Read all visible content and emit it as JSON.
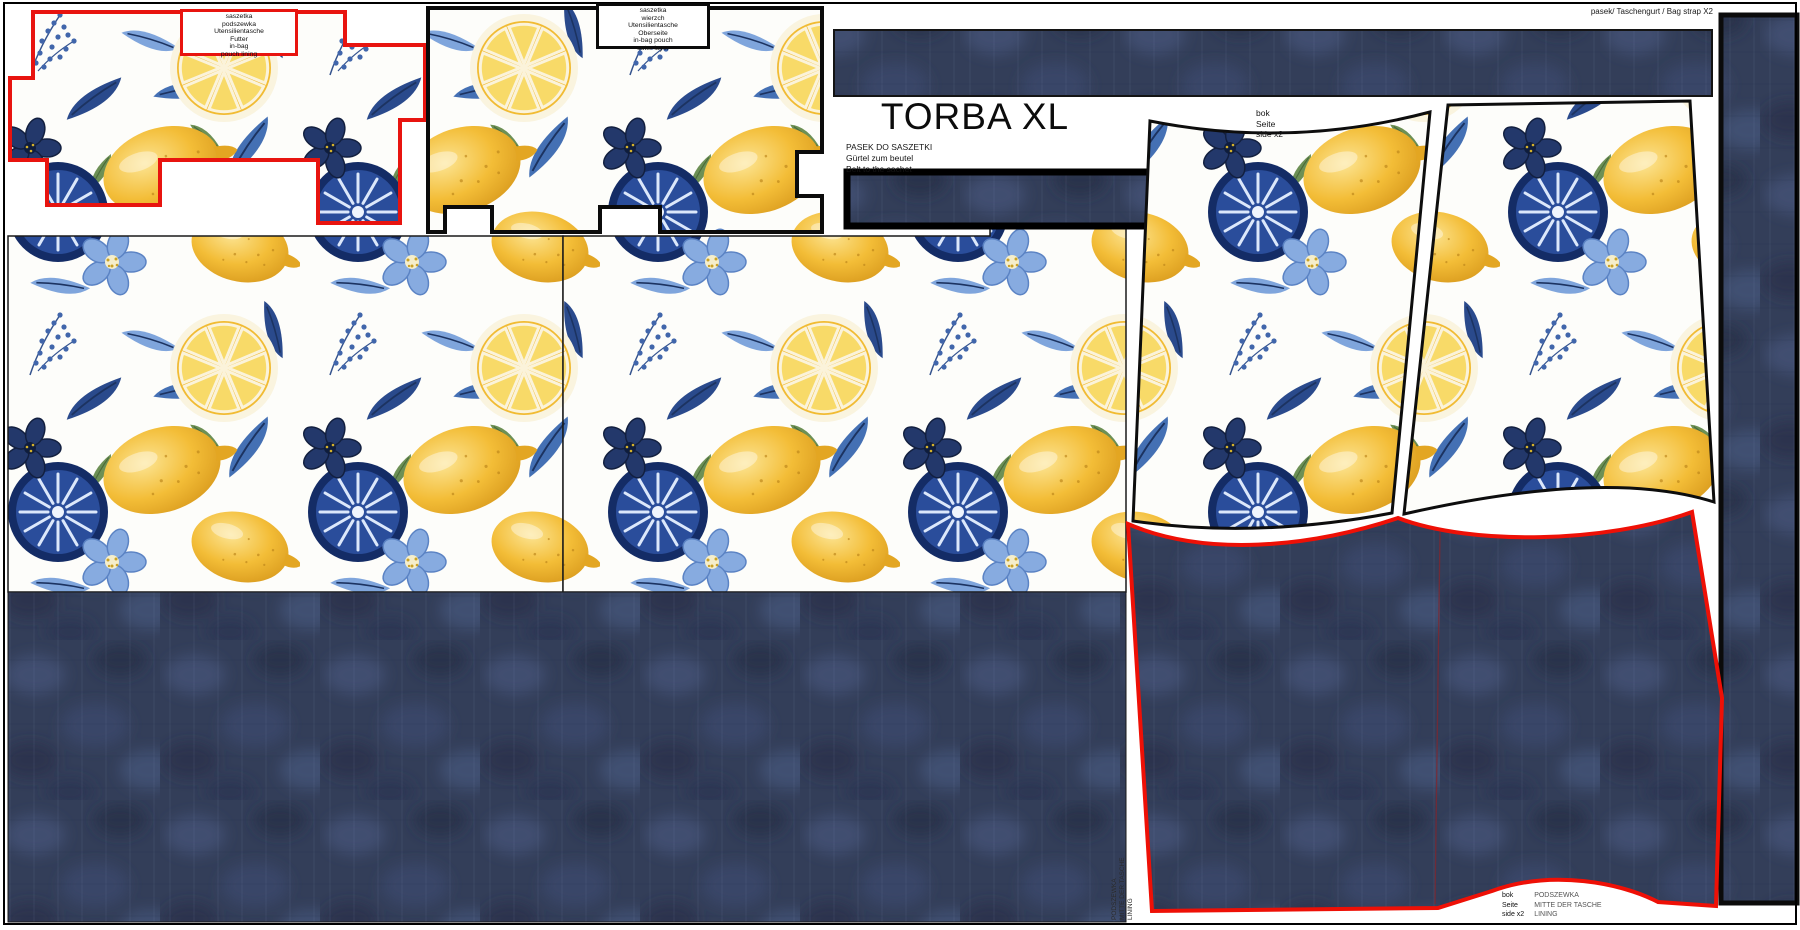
{
  "title": "TORBA XL",
  "labels": {
    "pouch_lining": {
      "lines": [
        "saszetka",
        "podszewka",
        "Utensilientasche",
        "Futter",
        "in-bag",
        "pouch lining"
      ]
    },
    "pouch_outer": {
      "lines": [
        "saszetka",
        "wierzch",
        "Utensilientasche",
        "Oberseite",
        "in-bag pouch",
        "outer layer"
      ]
    },
    "bag_strap": "pasek/ Taschengurt / Bag strap X2",
    "belt": {
      "lines": [
        "PASEK DO SASZETKI",
        "Gürtel zum beutel",
        "Belt to the sachet"
      ]
    },
    "side": {
      "lines": [
        "bok",
        "Seite",
        "side x2"
      ]
    },
    "side_lining_vertical": {
      "lines": [
        "PODSZEWKA",
        "MITTE DER TASCHE",
        "LINING"
      ]
    },
    "side_lining_bottom": {
      "left": [
        "bok",
        "Seite",
        "side x2"
      ],
      "right": [
        "PODSZEWKA",
        "MITTE DER TASCHE",
        "LINING"
      ]
    }
  },
  "colors": {
    "background": "#ffffff",
    "denim_navy": "#333e59",
    "outline_red": "#e8140f",
    "outline_black": "#0b0b0b",
    "lemon_yellow": "#f3bd37",
    "leaf_blue": "#4470b4",
    "dark_slice_navy": "#142c66",
    "flower_blue": "#87abe0"
  }
}
